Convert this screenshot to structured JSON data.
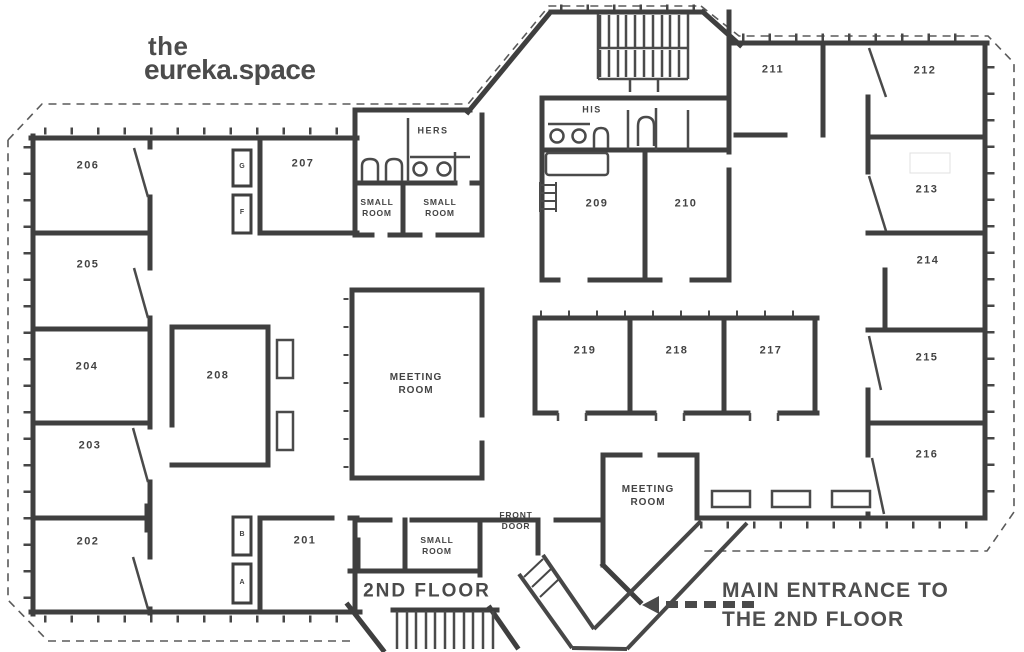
{
  "logo": {
    "line1": "the",
    "line2": "eureka.space"
  },
  "labels": {
    "floor": "2ND FLOOR",
    "entrance_note": "MAIN ENTRANCE TO THE 2ND FLOOR",
    "front_door": "FRONT DOOR",
    "meeting_room_center": "MEETING ROOM",
    "meeting_room_south": "MEETING ROOM",
    "small_room_top_left": "SMALL ROOM",
    "small_room_top_right": "SMALL ROOM",
    "small_room_bottom": "SMALL ROOM",
    "wc_womens": "HERS",
    "wc_mens": "HIS"
  },
  "rooms": {
    "r201": "201",
    "r202": "202",
    "r203": "203",
    "r204": "204",
    "r205": "205",
    "r206": "206",
    "r207": "207",
    "r208": "208",
    "r209": "209",
    "r210": "210",
    "r211": "211",
    "r212": "212",
    "r213": "213",
    "r214": "214",
    "r215": "215",
    "r216": "216",
    "r217": "217",
    "r218": "218",
    "r219": "219"
  },
  "utility_boxes": {
    "north_1": "G",
    "north_2": "F",
    "south_1": "B",
    "south_2": "A"
  },
  "colors": {
    "wall": "#3f3f3f",
    "text": "#434343",
    "boundary_dash": "#5a5a5a"
  }
}
